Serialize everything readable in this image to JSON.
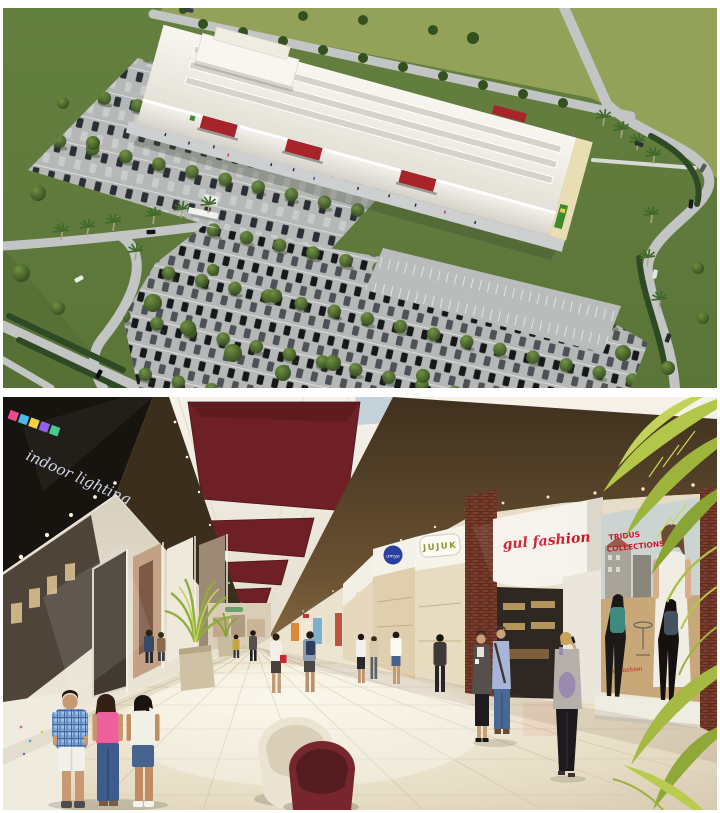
{
  "page": {
    "background_color": "#ffffff"
  },
  "aerial": {
    "colors": {
      "banner_red": "#a6242a",
      "grass": "#6d8846",
      "lawn": "#97a35b",
      "road": "#c3c5c4",
      "roof": "#f2f0e8",
      "accent_green_sign": "#3f8a2f"
    }
  },
  "interior": {
    "colors": {
      "coffer_maroon": "#6e2026",
      "bulkhead_brown": "#5e4930",
      "sign_red": "#cf1626",
      "jujuk_green": "#8a9a33",
      "logo_blue": "#2a3fa0"
    },
    "signs": {
      "indoor_lighting": "indoor lighting",
      "blue_logo": "amya",
      "jujuk": "JUJUK",
      "fashion": "gul fashion",
      "poster_title_line1": "TRIDUS",
      "poster_title_line2": "COLLECTIONS",
      "poster_footer": "gul fashion"
    }
  }
}
